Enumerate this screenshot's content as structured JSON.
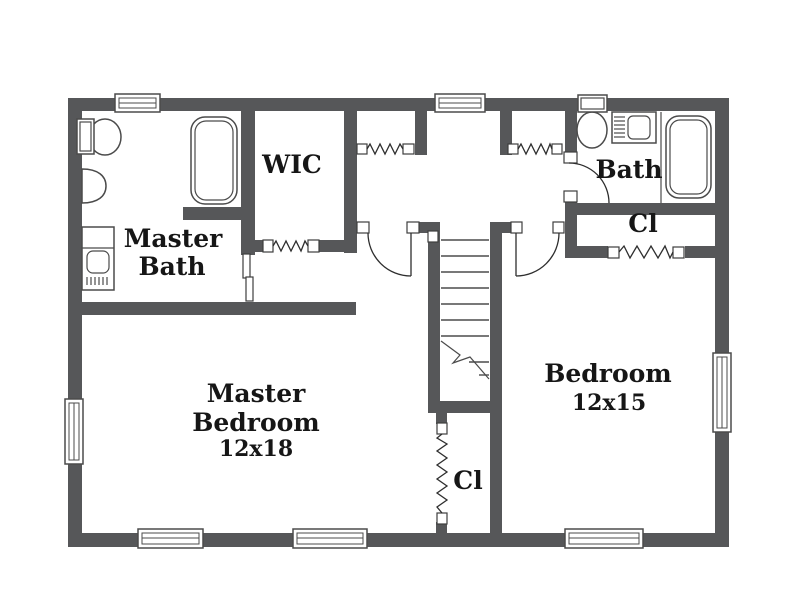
{
  "rooms": {
    "master_bath": {
      "label_line1": "Master",
      "label_line2": "Bath"
    },
    "wic": {
      "label": "WIC"
    },
    "bath": {
      "label": "Bath"
    },
    "bath_closet": {
      "label": "Cl"
    },
    "bedroom": {
      "label": "Bedroom",
      "dimensions": "12x15"
    },
    "master_bedroom": {
      "label_line1": "Master",
      "label_line2": "Bedroom",
      "dimensions": "12x18"
    },
    "under_stair_closet": {
      "label": "Cl"
    }
  },
  "features": {
    "windows": 7,
    "swing_doors": 3,
    "accordion_doors": 5,
    "pocket_doors": 1,
    "staircase": 1,
    "fixtures": [
      "toilet",
      "pedestal-sink",
      "vanity-sink",
      "bathtub"
    ]
  },
  "colors": {
    "wall": "#565759",
    "fixture_line": "#4b4b4b",
    "door_line": "#2e2e2e",
    "text": "#161616",
    "background": "#ffffff"
  }
}
